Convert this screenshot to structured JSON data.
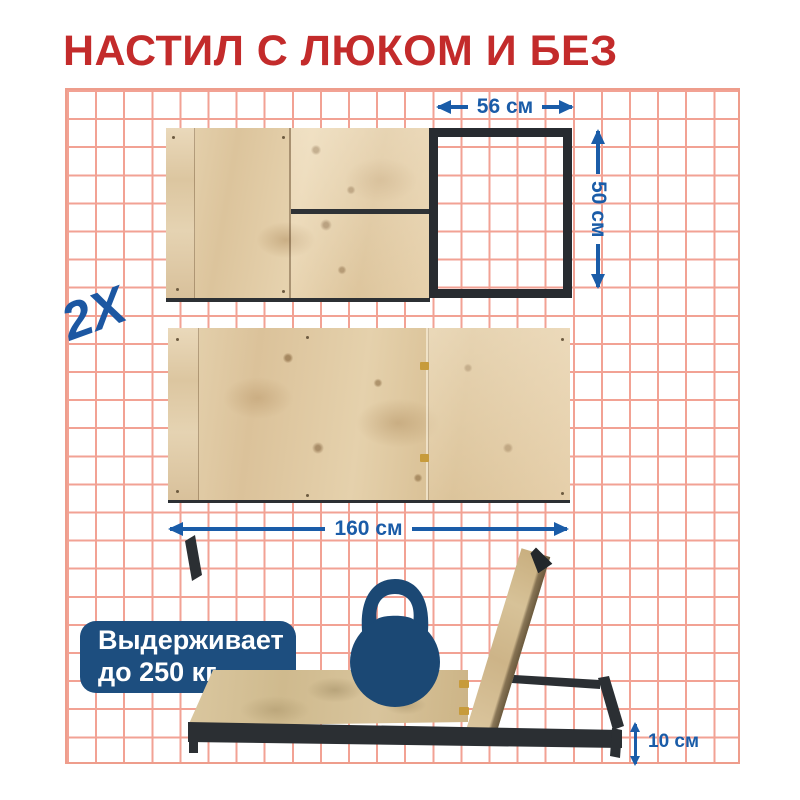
{
  "title": "НАСТИЛ С ЛЮКОМ И БЕЗ",
  "quantity_label": "2X",
  "dimensions": {
    "hatch_width": "56 см",
    "hatch_depth": "50 см",
    "deck_length": "160 см",
    "frame_height": "10 см"
  },
  "capacity_badge": {
    "line1": "Выдерживает",
    "line2": "до 250 кг"
  },
  "icons": {
    "kettlebell": "kettlebell-icon"
  },
  "colors": {
    "title_red": "#c32b2b",
    "dimension_blue": "#1a5ca8",
    "badge_navy": "#1d4e7f",
    "kettlebell_navy": "#1b4874",
    "grid_line_salmon": "#f2a294",
    "frame_dark": "#2b2f33"
  }
}
